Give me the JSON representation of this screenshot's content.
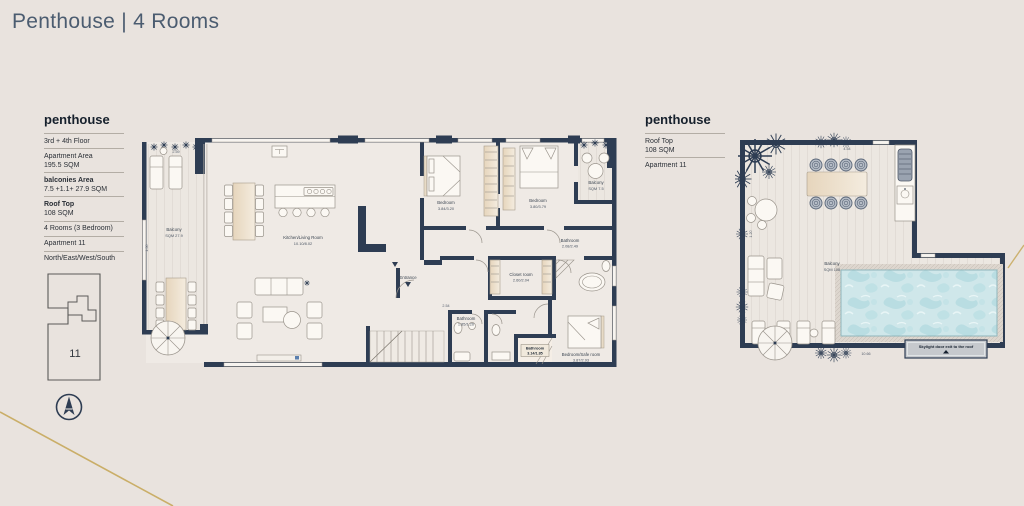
{
  "page": {
    "title": "Penthouse | 4 Rooms"
  },
  "colors": {
    "background": "#e9e3de",
    "wall_navy": "#2e3d53",
    "accent_gold": "#c7a95c",
    "pool_water": "#cfe7ea",
    "title_text": "#4b5c70"
  },
  "info_panel": {
    "header": "penthouse",
    "rows": [
      {
        "label": "3rd + 4th Floor",
        "value": ""
      },
      {
        "label": "Apartment Area",
        "value": "195.5 SQM"
      },
      {
        "label": "balconies Area",
        "value": "7.5 +1.1+ 27.9 SQM"
      },
      {
        "label": "Roof Top",
        "value": "108 SQM"
      },
      {
        "label": "4 Rooms (3 Bedroom)",
        "value": ""
      },
      {
        "label": "Apartment 11",
        "value": ""
      },
      {
        "label": "North/East/West/South",
        "value": ""
      }
    ],
    "unit_number": "11"
  },
  "roof_panel": {
    "header": "penthouse",
    "rows": [
      {
        "label": "Roof Top",
        "value": "108 SQM"
      },
      {
        "label": "Apartment 11",
        "value": ""
      }
    ]
  },
  "main_plan": {
    "labels": {
      "balcony_left": {
        "name": "Balcony",
        "dims": "SQM 27.9"
      },
      "kitchen_living": {
        "name": "Kitchen/Living Room",
        "dims": "10.10/8.02"
      },
      "bedroom_left": {
        "name": "Bedroom",
        "dims": "3.84/3.20"
      },
      "bedroom_mid": {
        "name": "Bedroom",
        "dims": "3.80/3.79"
      },
      "balcony_top": {
        "name": "Balcony",
        "dims": "SQM 7.5"
      },
      "bathroom_main": {
        "name": "Bathroom",
        "dims": "2.08/2.49"
      },
      "closet": {
        "name": "Closet room",
        "dims": "2.60/2.04"
      },
      "bathroom_small": {
        "name": "Bathroom",
        "dims": "1.85/1.26"
      },
      "bathroom_master": {
        "name": "Bathroom",
        "dims": "3.14/1.85"
      },
      "safe_room": {
        "name": "Bedroom/Safe room",
        "dims": "3.87/2.93"
      },
      "entrance": "Entrance",
      "dim_top_balcony": "2.59",
      "dim_hall": "2.54",
      "dim_left": "1.50"
    }
  },
  "roof_plan": {
    "labels": {
      "balcony": {
        "name": "Balcony",
        "dims": "SQM 108"
      },
      "skylight_note": "Skylight door exit to the roof",
      "dim_top": "4.54",
      "dim_bottom": "10.66",
      "dim_left": "1.20"
    }
  }
}
